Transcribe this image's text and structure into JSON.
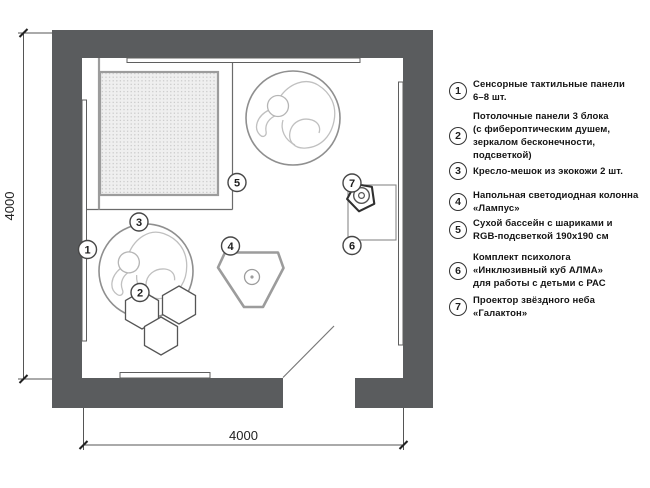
{
  "colors": {
    "wall": "#5a5c5e",
    "outline": "#6b6b6b",
    "soft_outline": "#9c9c9c",
    "hatch_dot": "#c6c6c6",
    "hatch_bg": "#efefef",
    "beanbag_line": "#c0c0c0",
    "dark": "#2f2f2f"
  },
  "plan": {
    "dimensions": {
      "width": "4000",
      "height": "4000"
    },
    "callouts": [
      {
        "n": "1"
      },
      {
        "n": "2"
      },
      {
        "n": "3"
      },
      {
        "n": "4"
      },
      {
        "n": "5"
      },
      {
        "n": "6"
      },
      {
        "n": "7"
      }
    ]
  },
  "legend": {
    "items": [
      {
        "number": "1",
        "lines": [
          "Сенсорные тактильные панели",
          "6–8 шт."
        ]
      },
      {
        "number": "2",
        "lines": [
          "Потолочные панели 3 блока",
          "(с фибероптическим душем,",
          "зеркалом бесконечности,",
          "подсветкой)"
        ]
      },
      {
        "number": "3",
        "lines": [
          "Кресло-мешок из экокожи 2 шт."
        ]
      },
      {
        "number": "4",
        "lines": [
          "Напольная светодиодная колонна",
          "«Лампус»"
        ]
      },
      {
        "number": "5",
        "lines": [
          "Сухой бассейн с шариками и",
          "RGB-подсветкой 190х190 см"
        ]
      },
      {
        "number": "6",
        "lines": [
          "Комплект психолога",
          "«Инклюзивный куб АЛМА»",
          "для работы с детьми с РАС"
        ]
      },
      {
        "number": "7",
        "lines": [
          "Проектор звёздного неба",
          "«Галактон»"
        ]
      }
    ]
  }
}
